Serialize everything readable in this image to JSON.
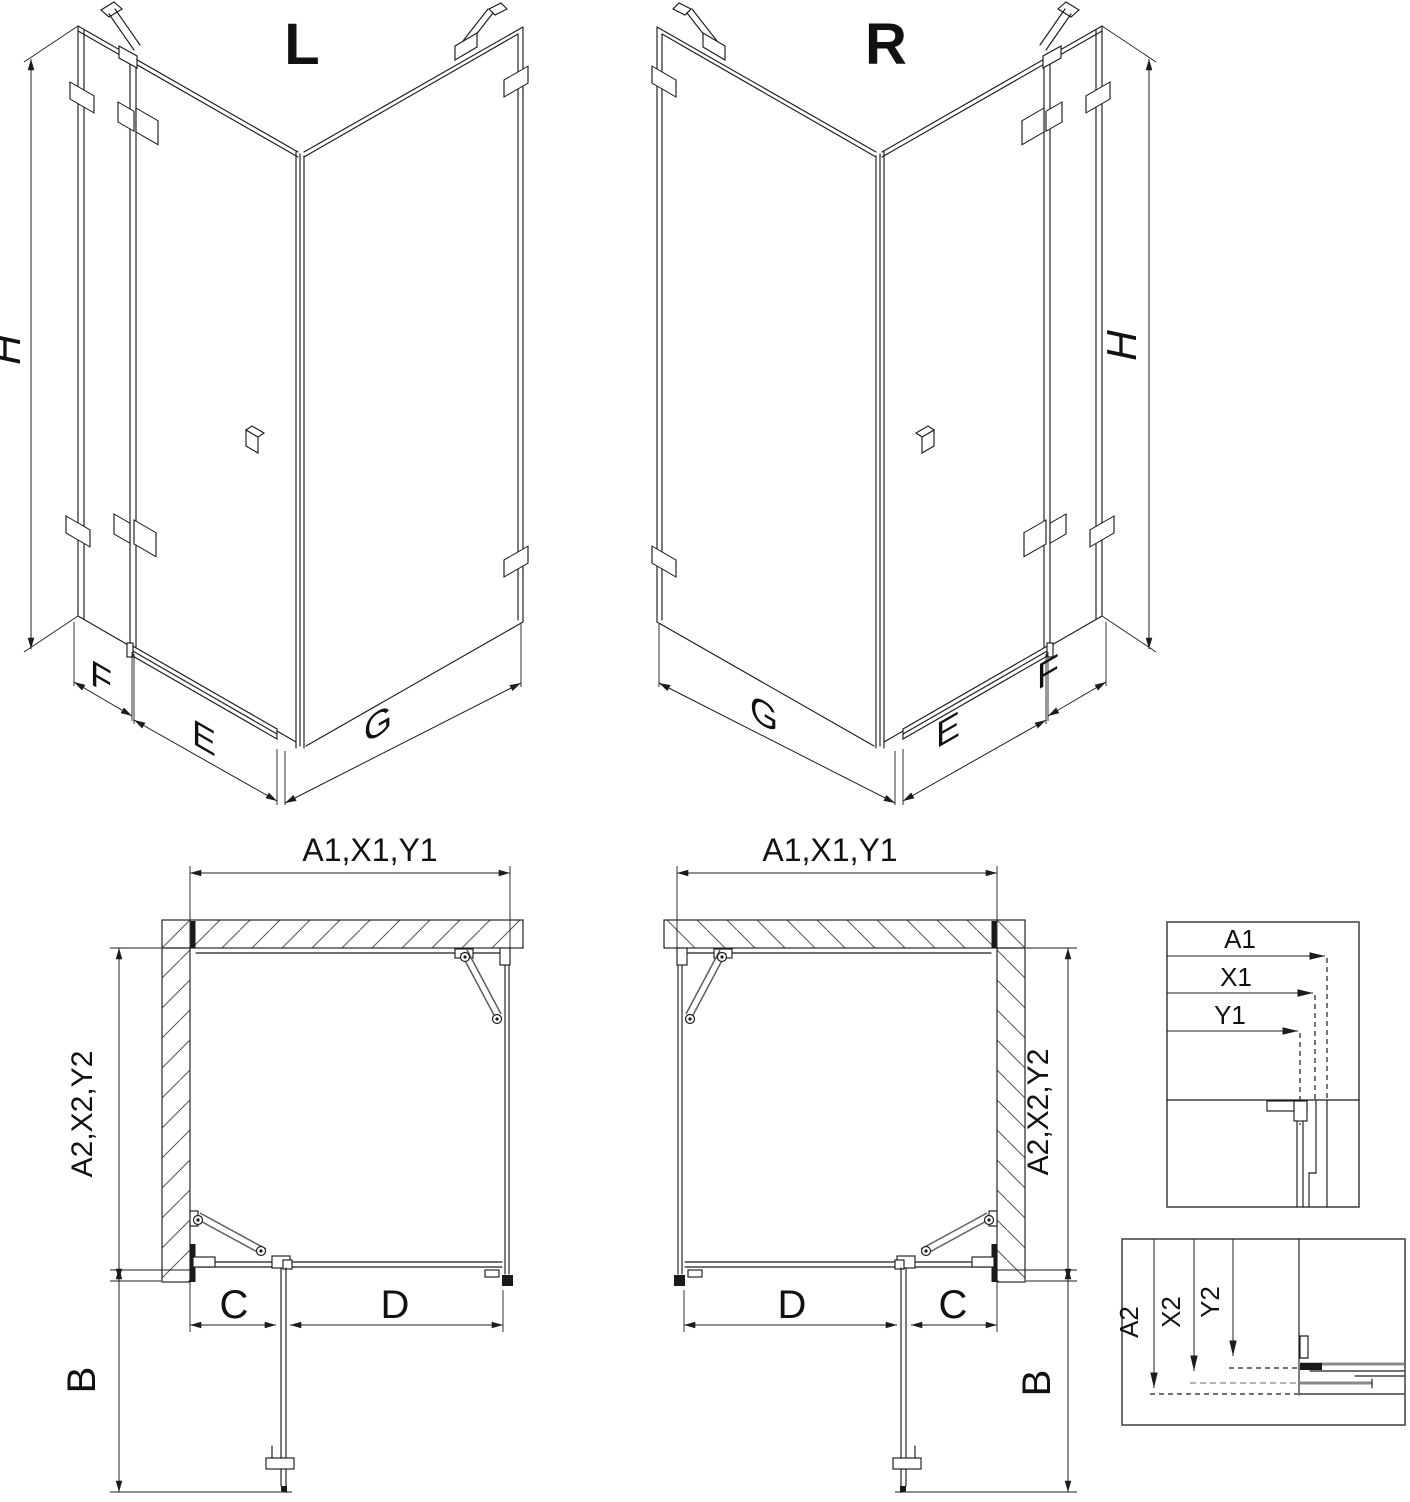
{
  "drawing": {
    "background": "#ffffff",
    "line_color": "#1c1c1c",
    "accent_gray": "#8a8a8a",
    "views": {
      "iso_left": {
        "label": "L",
        "height_dim": "H",
        "side_panel_dim": "F",
        "door_dim": "E",
        "wall_panel_dim": "G"
      },
      "iso_right": {
        "label": "R",
        "height_dim": "H",
        "side_panel_dim": "F",
        "door_dim": "E",
        "wall_panel_dim": "G"
      },
      "plan_left": {
        "width_dim": "A1,X1,Y1",
        "depth_dim": "A2,X2,Y2",
        "swing_dim": "B",
        "fixed_dim": "C",
        "door_dim": "D"
      },
      "plan_right": {
        "width_dim": "A1,X1,Y1",
        "depth_dim": "A2,X2,Y2",
        "swing_dim": "B",
        "fixed_dim": "C",
        "door_dim": "D"
      },
      "detail_width": {
        "dims": [
          "A1",
          "X1",
          "Y1"
        ]
      },
      "detail_depth": {
        "dims": [
          "A2",
          "X2",
          "Y2"
        ]
      }
    }
  }
}
